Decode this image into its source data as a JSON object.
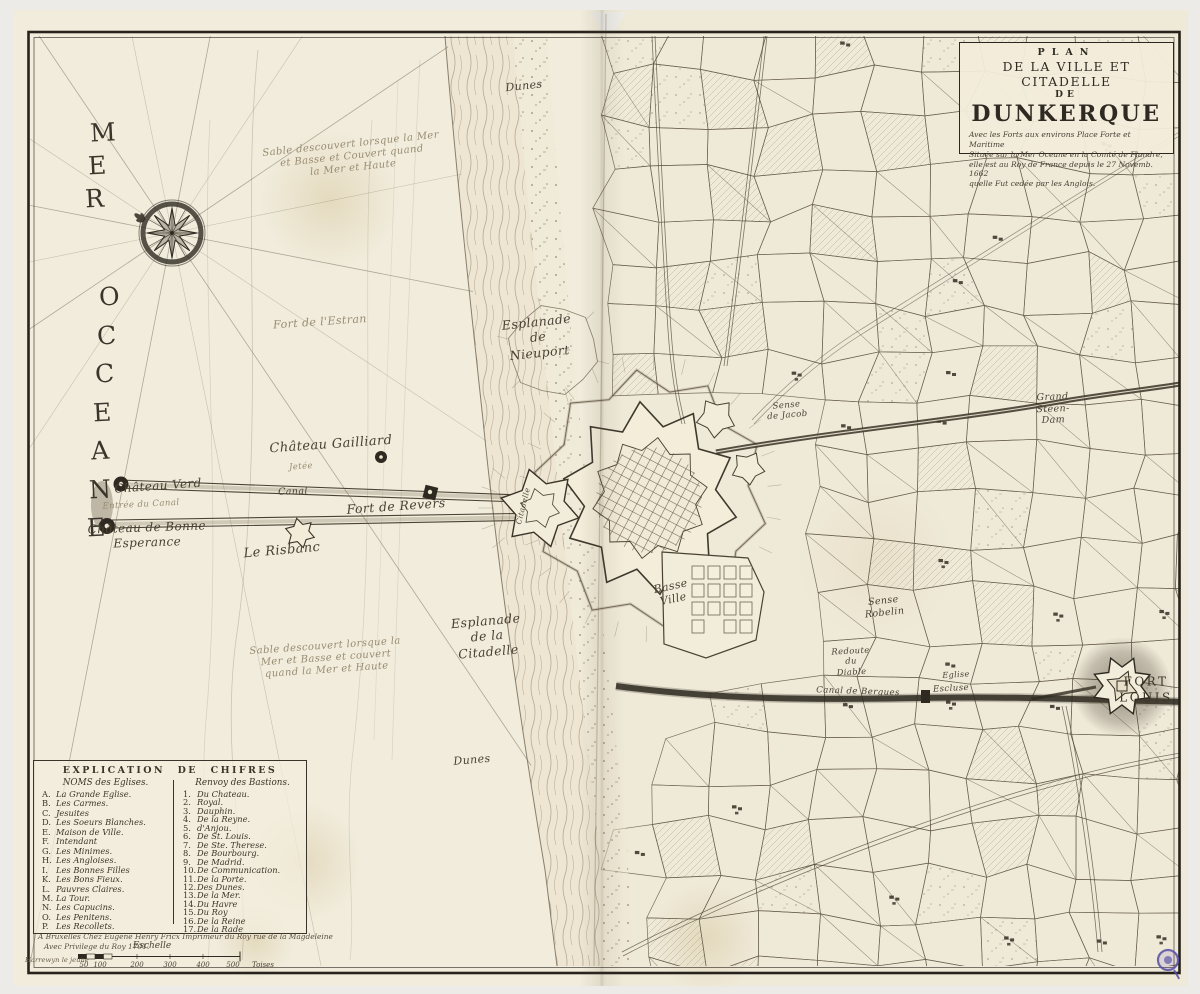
{
  "colors": {
    "paper": "#f1ecdc",
    "ink": "#2e2a21",
    "engrave": "#6b6150",
    "stamp": "#584da6"
  },
  "title_cartouche": {
    "lines": [
      "PLAN",
      "DE LA VILLE ET CITADELLE",
      "DE",
      "DUNKERQUE"
    ],
    "subtitle_lines": [
      "Avec les Forts aux environs Place Forte et Maritime",
      "Située sur la Mer Oceane en la Comté de Flandre,",
      "elle est au Roy de France depuis le 27 Novemb. 1662",
      "quelle Fut cedée par les Anglois."
    ]
  },
  "sea": {
    "words": [
      "MER",
      "OCCEANE"
    ]
  },
  "map_labels": [
    {
      "id": "dunes-top",
      "text": "Dunes",
      "x": 524,
      "y": 86,
      "size": 11,
      "rot": -6
    },
    {
      "id": "sandbank-note-top",
      "text": "Sable descouvert lorsque la Mer\net Basse et Couvert quand\nla Mer et Haute",
      "x": 352,
      "y": 157,
      "size": 10,
      "rot": -6,
      "cls": "faint"
    },
    {
      "id": "fort-estran",
      "text": "Fort de l'Estran",
      "x": 320,
      "y": 322,
      "size": 11,
      "rot": -4,
      "cls": "faint"
    },
    {
      "id": "esplanade-nieuport",
      "text": "Esplanade\nde\nNieuport",
      "x": 538,
      "y": 337,
      "size": 12.5,
      "rot": -6
    },
    {
      "id": "chateau-gailliard",
      "text": "Château Gailliard",
      "x": 331,
      "y": 445,
      "size": 13,
      "rot": -4
    },
    {
      "id": "jetee",
      "text": "Jetée",
      "x": 301,
      "y": 467,
      "size": 8.5,
      "rot": -4,
      "cls": "faint"
    },
    {
      "id": "canal",
      "text": "Canal",
      "x": 293,
      "y": 492,
      "size": 9.5,
      "rot": -2
    },
    {
      "id": "chateau-verd",
      "text": "Château Verd",
      "x": 158,
      "y": 486,
      "size": 12,
      "rot": -4
    },
    {
      "id": "entree-du-canal",
      "text": "Entrée du Canal",
      "x": 141,
      "y": 505,
      "size": 8.6,
      "rot": -3,
      "cls": "faint"
    },
    {
      "id": "chateau-bonne-esperance",
      "text": "Château de Bonne\nEsperance",
      "x": 147,
      "y": 535,
      "size": 12,
      "rot": -2
    },
    {
      "id": "fort-de-revers",
      "text": "Fort de Revers",
      "x": 396,
      "y": 506,
      "size": 12.5,
      "rot": -4
    },
    {
      "id": "le-risbanc",
      "text": "Le Risbanc",
      "x": 282,
      "y": 551,
      "size": 13,
      "rot": -5
    },
    {
      "id": "esplanade-citadelle",
      "text": "Esplanade\nde la\nCitadelle",
      "x": 487,
      "y": 636,
      "size": 12.5,
      "rot": -5
    },
    {
      "id": "sandbank-note-bottom",
      "text": "Sable descouvert lorsque la\nMer et Basse et couvert\nquand la Mer et Haute",
      "x": 326,
      "y": 659,
      "size": 10,
      "rot": -4,
      "cls": "faint"
    },
    {
      "id": "dunes-bottom",
      "text": "Dunes",
      "x": 472,
      "y": 760,
      "size": 11,
      "rot": -5
    },
    {
      "id": "basse-ville",
      "text": "Basse\nVille",
      "x": 672,
      "y": 593,
      "size": 11,
      "rot": -12
    },
    {
      "id": "citadelle",
      "text": "Citadelle",
      "x": 523,
      "y": 506,
      "size": 7.5,
      "rot": -76
    },
    {
      "id": "sense-de-jacob",
      "text": "Sense\nde Jacob",
      "x": 787,
      "y": 411,
      "size": 8.6,
      "rot": -5
    },
    {
      "id": "grand-steen-dam",
      "text": "Grand\nSteen-\nDam",
      "x": 1053,
      "y": 409,
      "size": 9.5,
      "rot": -2
    },
    {
      "id": "sense-robelin",
      "text": "Sense\nRobelin",
      "x": 884,
      "y": 607,
      "size": 9.5,
      "rot": -6
    },
    {
      "id": "redoute-du-diable",
      "text": "Redoute\ndu\nDiable",
      "x": 851,
      "y": 661,
      "size": 8.4,
      "rot": -3
    },
    {
      "id": "canal-de-bergues",
      "text": "Canal de Bergues",
      "x": 858,
      "y": 692,
      "size": 8.6,
      "rot": 2
    },
    {
      "id": "eglise",
      "text": "Eglise",
      "x": 956,
      "y": 675,
      "size": 8,
      "rot": -3
    },
    {
      "id": "escluse",
      "text": "Escluse",
      "x": 951,
      "y": 689,
      "size": 8.6,
      "rot": -3
    },
    {
      "id": "fort-louis",
      "text": "FORT\nLOUIS",
      "x": 1146,
      "y": 690,
      "size": 12,
      "rot": 0,
      "cls": "caps"
    }
  ],
  "legend": {
    "header": "EXPLICATION DE CHIFRES",
    "churches": {
      "header": "NOMS des Eglises.",
      "items": [
        {
          "key": "A",
          "name": "La Grande Eglise."
        },
        {
          "key": "B",
          "name": "Les Carmes."
        },
        {
          "key": "C",
          "name": "Jesuites"
        },
        {
          "key": "D",
          "name": "Les Soeurs Blanches."
        },
        {
          "key": "E",
          "name": "Maison de Ville."
        },
        {
          "key": "F",
          "name": "Intendant"
        },
        {
          "key": "G",
          "name": "Les Minimes."
        },
        {
          "key": "H",
          "name": "Les Angloises."
        },
        {
          "key": "I",
          "name": "Les Bonnes Filles"
        },
        {
          "key": "K",
          "name": "Les Bons Fieux."
        },
        {
          "key": "L",
          "name": "Pauvres Claires."
        },
        {
          "key": "M",
          "name": "La Tour."
        },
        {
          "key": "N",
          "name": "Les Capucins."
        },
        {
          "key": "O",
          "name": "Les Penitens."
        },
        {
          "key": "P",
          "name": "Les Recollets."
        }
      ]
    },
    "bastions": {
      "header": "Renvoy des Bastions.",
      "items": [
        {
          "key": "1",
          "name": "Du Chateau."
        },
        {
          "key": "2",
          "name": "Royal."
        },
        {
          "key": "3",
          "name": "Dauphin."
        },
        {
          "key": "4",
          "name": "De la Reyne."
        },
        {
          "key": "5",
          "name": "d'Anjou."
        },
        {
          "key": "6",
          "name": "De St. Louis."
        },
        {
          "key": "7",
          "name": "De Ste. Therese."
        },
        {
          "key": "8",
          "name": "De Bourbourg."
        },
        {
          "key": "9",
          "name": "De Madrid."
        },
        {
          "key": "10",
          "name": "De Communication."
        },
        {
          "key": "11",
          "name": "De la Porte."
        },
        {
          "key": "12",
          "name": "Des Dunes."
        },
        {
          "key": "13",
          "name": "De la Mer."
        },
        {
          "key": "14",
          "name": "Du Havre"
        },
        {
          "key": "15",
          "name": "Du Roy"
        },
        {
          "key": "16",
          "name": "De la Reine"
        },
        {
          "key": "17",
          "name": "De la Rade"
        }
      ]
    }
  },
  "imprint": {
    "line1": "A Bruxelles Chez Eugene Henry Fricx Imprimeur du Roy rue de la Magdeleine",
    "line2": "Avec Privilege du Roy 1701."
  },
  "scale_bar": {
    "title": "Eschelle",
    "engraver": "Harrewyn le jeune",
    "ticks": [
      "50",
      "100",
      "200",
      "300",
      "400",
      "500"
    ],
    "unit": "Toises"
  }
}
